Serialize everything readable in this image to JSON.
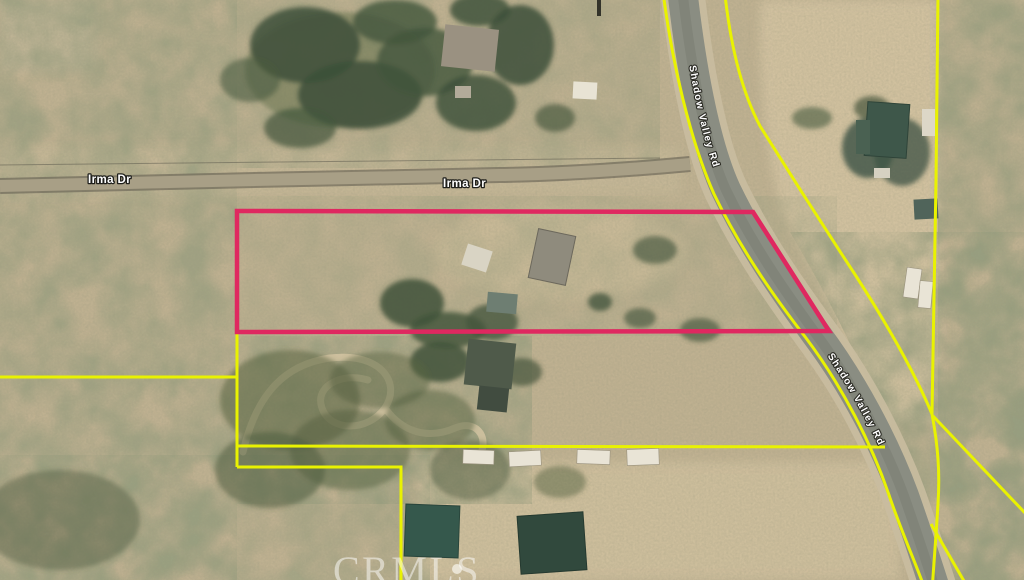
{
  "map": {
    "streets": {
      "irma_label": "Irma Dr",
      "diagonal_label": "Shadow Valley Rd"
    },
    "watermark": "CRMLS",
    "colors": {
      "parcel_outline": "#df2860",
      "boundary": "#e9f201",
      "road": "#8a8d82",
      "terrain": "#bfb191",
      "street_label": "#ffffff"
    }
  }
}
